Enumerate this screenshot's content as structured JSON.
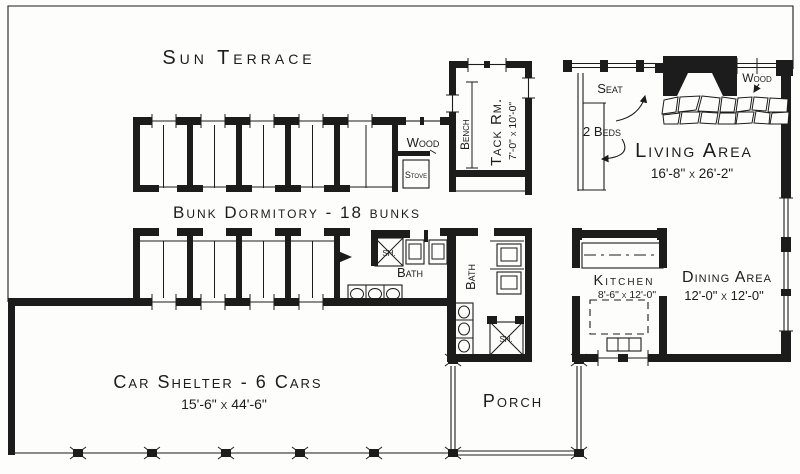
{
  "colors": {
    "ink": "#1c1c1c",
    "paper": "#fdfdfb"
  },
  "labels": {
    "sun_terrace": "Sun Terrace",
    "bunk_dormitory": "Bunk Dormitory - 18 bunks",
    "tack_room": "Tack Rm.",
    "tack_room_dims": "7'-0\" x 10'-0\"",
    "bench": "Bench",
    "wood_alcove": "Wood",
    "stove": "Stove",
    "living_area": "Living Area",
    "living_area_dims": "16'-8\" x 26'-2\"",
    "seat": "Seat",
    "two_beds": "2 Beds",
    "wood_fireplace": "Wood",
    "dining_area": "Dining Area",
    "dining_area_dims": "12'-0\" x 12'-0\"",
    "kitchen": "Kitchen",
    "kitchen_dims": "8'-6\" x 12'-0\"",
    "bath_left": "Bath",
    "bath_right": "Bath",
    "shower_left": "SH.",
    "shower_right": "SH.",
    "porch": "Porch",
    "car_shelter": "Car Shelter - 6 Cars",
    "car_shelter_dims": "15'-6\" x 44'-6\""
  }
}
